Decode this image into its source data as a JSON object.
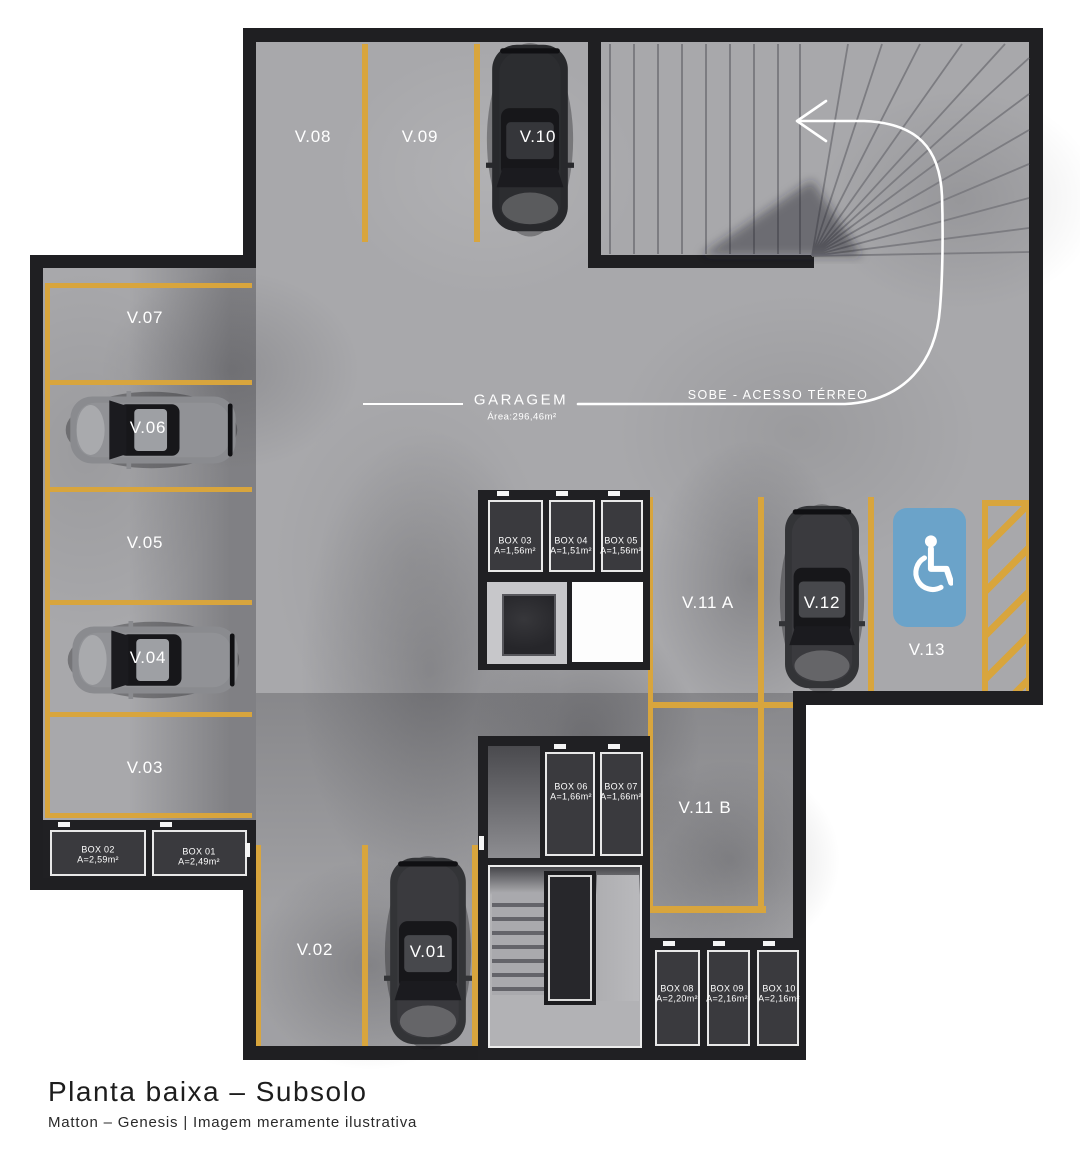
{
  "title": {
    "heading": "Planta baixa – Subsolo",
    "subheading": "Matton – Genesis | Imagem meramente ilustrativa"
  },
  "annotations": {
    "garage_label": "GARAGEM",
    "garage_area": "Área:296,46m²",
    "ramp_label": "SOBE - ACESSO TÉRREO"
  },
  "stalls": {
    "v01": "V.01",
    "v02": "V.02",
    "v03": "V.03",
    "v04": "V.04",
    "v05": "V.05",
    "v06": "V.06",
    "v07": "V.07",
    "v08": "V.08",
    "v09": "V.09",
    "v10": "V.10",
    "v11a": "V.11 A",
    "v11b": "V.11 B",
    "v12": "V.12",
    "v13": "V.13"
  },
  "boxes": {
    "box01": {
      "name": "BOX 01",
      "area": "A=2,49m²"
    },
    "box02": {
      "name": "BOX 02",
      "area": "A=2,59m²"
    },
    "box03": {
      "name": "BOX 03",
      "area": "A=1,56m²"
    },
    "box04": {
      "name": "BOX 04",
      "area": "A=1,51m²"
    },
    "box05": {
      "name": "BOX 05",
      "area": "A=1,56m²"
    },
    "box06": {
      "name": "BOX 06",
      "area": "A=1,66m²"
    },
    "box07": {
      "name": "BOX 07",
      "area": "A=1,66m²"
    },
    "box08": {
      "name": "BOX 08",
      "area": "A=2,20m²"
    },
    "box09": {
      "name": "BOX 09",
      "area": "A=2,16m²"
    },
    "box10": {
      "name": "BOX 10",
      "area": "A=2,16m²"
    }
  },
  "colors": {
    "wall": "#1f1f22",
    "floor": "#a8a8ab",
    "marking_yellow": "#d8a53d",
    "accessible_blue": "#6ba3c9",
    "text_dark": "#1d1d1d"
  },
  "icons": {
    "wheelchair": "accessible-parking-icon",
    "arrow": "ramp-direction-arrow"
  }
}
